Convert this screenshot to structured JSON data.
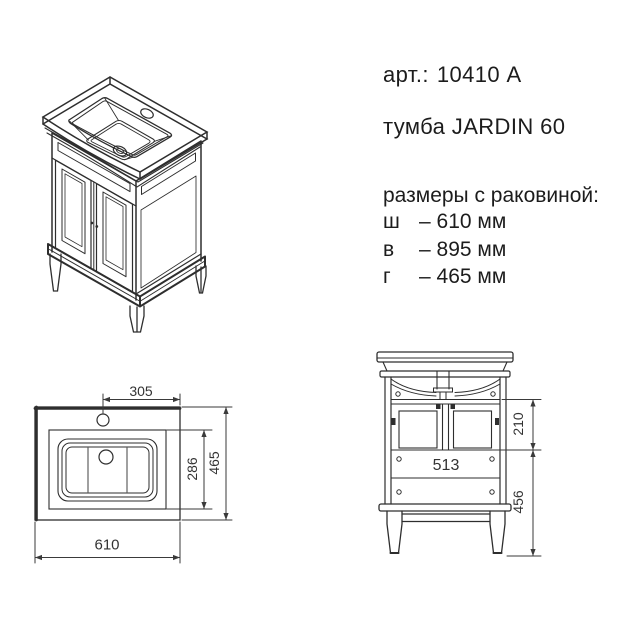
{
  "header": {
    "article_label": "арт.:",
    "article_value": "10410 A",
    "product_name": "тумба JARDIN 60"
  },
  "specs": {
    "title": "размеры с раковиной:",
    "rows": [
      {
        "letter": "ш",
        "value": "– 610 мм"
      },
      {
        "letter": "в",
        "value": "– 895 мм"
      },
      {
        "letter": "г",
        "value": "– 465 мм"
      }
    ]
  },
  "top_view": {
    "dim_faucet_offset": "305",
    "dim_width": "610",
    "dim_basin_depth": "286",
    "dim_depth": "465"
  },
  "front_view": {
    "dim_inner_width": "513",
    "dim_opening_height": "210",
    "dim_lower_height": "456"
  },
  "colors": {
    "line": "#2e2e2e",
    "dim_line": "#3a3a3a",
    "text": "#1c1c1c",
    "background": "#ffffff"
  }
}
